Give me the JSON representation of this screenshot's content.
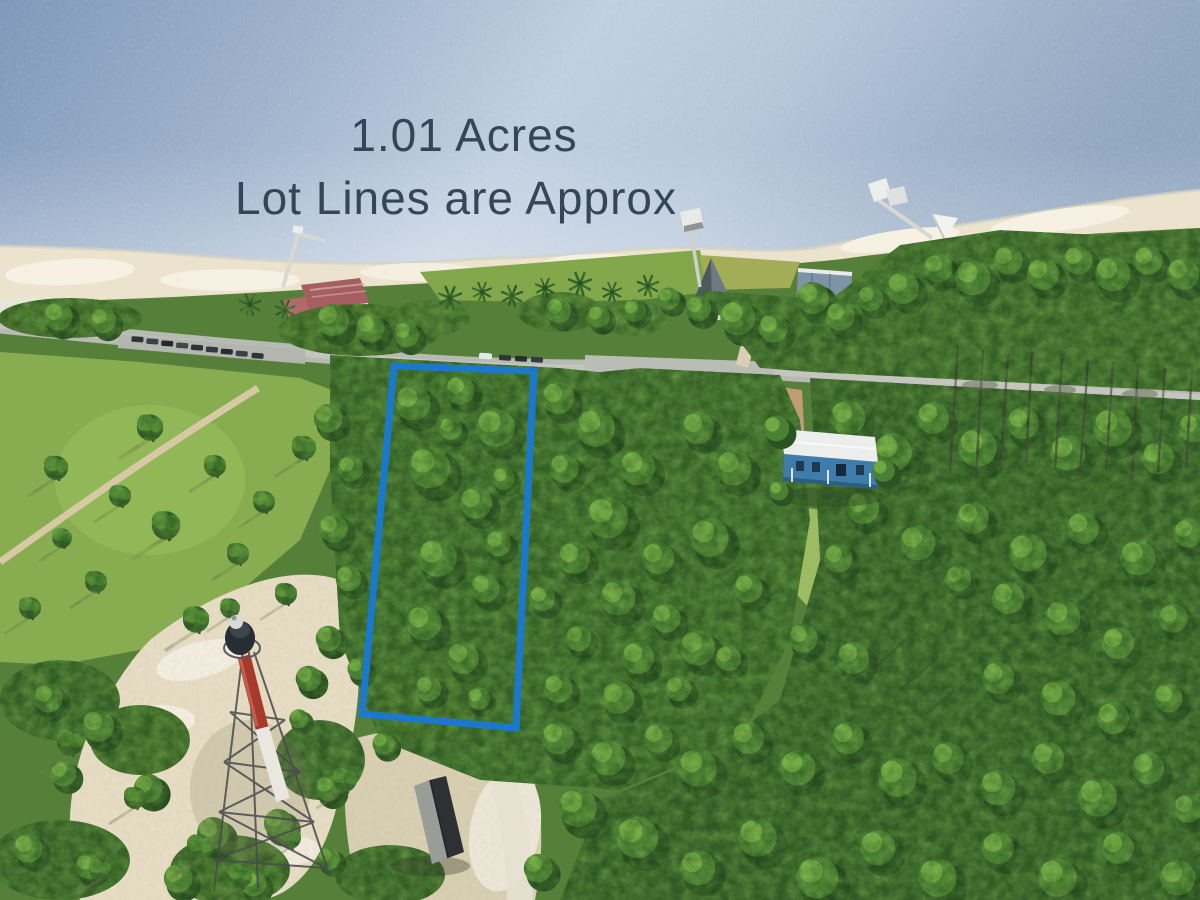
{
  "annotation": {
    "line1": "1.01 Acres",
    "line2": "Lot Lines are Approx",
    "text_color": "#2c3b4d",
    "lot_outline_color": "#1a79d2"
  },
  "scene": {
    "landmarks": [
      "bay-water",
      "sand-beach",
      "shore-road",
      "parked-cars",
      "left-fishing-pier",
      "center-pier-gazebo",
      "right-pier-deck",
      "pink-roof-building",
      "teal-house",
      "gray-building",
      "blue-house",
      "skeletal-lighthouse",
      "storage-shed",
      "pine-forest",
      "grass-park",
      "sandy-clearings",
      "lot-boundary-outline"
    ]
  },
  "palette": {
    "water_deep": "#7d96b9",
    "water_light": "#c0cfe0",
    "sand": "#ebe3cd",
    "road": "#b7b9b3",
    "forest_dark": "#2e5523",
    "forest_mid": "#4b7d33",
    "forest_light": "#7fb44e",
    "grass": "#87ad50"
  }
}
